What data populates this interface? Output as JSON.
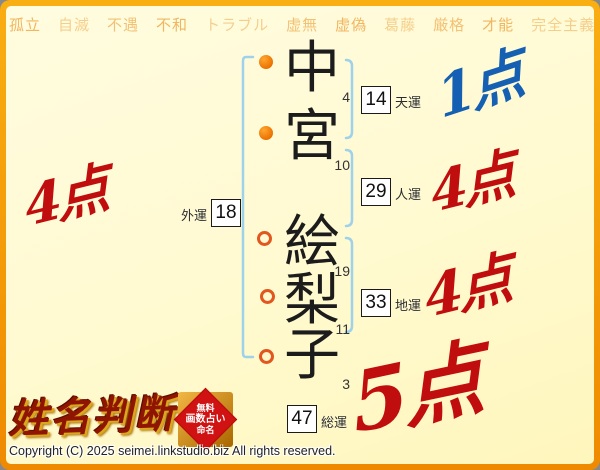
{
  "background": {
    "repeat": 5,
    "words": [
      "孤立",
      "自滅",
      "不遇",
      "不和",
      "トラブル",
      "虚無",
      "虚偽",
      "葛藤",
      "厳格",
      "才能",
      "完全主義",
      "知謀",
      "参謀",
      "開運",
      "勇気",
      "成功",
      "頭領",
      "剛健",
      "剛気",
      "権欲",
      "結実",
      "円満",
      "発展",
      "開花",
      "篤実",
      "蓄財",
      "信頼性",
      "忍耐",
      "戦闘",
      "情熱"
    ]
  },
  "name": {
    "chars": [
      {
        "char": "中",
        "strokes": "4",
        "part": "surname"
      },
      {
        "char": "宮",
        "strokes": "10",
        "part": "surname"
      },
      {
        "char": "絵",
        "strokes": "19",
        "part": "given"
      },
      {
        "char": "梨",
        "strokes": "11",
        "part": "given"
      },
      {
        "char": "子",
        "strokes": "3",
        "part": "given"
      }
    ]
  },
  "fortunes": {
    "ten": {
      "label": "天運",
      "value": "14",
      "score": "1点",
      "score_color": "#1560b2"
    },
    "jin": {
      "label": "人運",
      "value": "29",
      "score": "4点",
      "score_color": "#c00d0d"
    },
    "gai": {
      "label": "外運",
      "value": "18",
      "score": "4点",
      "score_color": "#c00d0d"
    },
    "chi": {
      "label": "地運",
      "value": "33",
      "score": "4点",
      "score_color": "#c00d0d"
    },
    "sou": {
      "label": "総運",
      "value": "47",
      "score": "5点",
      "score_color": "#c00d0d"
    }
  },
  "logo": {
    "title": "姓名判断",
    "stamp": {
      "lines": [
        "無料",
        "画数占い",
        "命名"
      ]
    }
  },
  "footer": {
    "copyright": "Copyright (C) 2025 seimei.linkstudio.biz All rights reserved."
  },
  "colors": {
    "frame_orange": "#f39a00",
    "page_bg": "#fffad0",
    "bg_words": "#f0b35c",
    "bracket_blue": "#9ed1ec",
    "marker_orange": "#ee7a00",
    "score_red": "#c00d0d",
    "score_blue": "#1560b2",
    "logo_red": "#8f1500"
  }
}
